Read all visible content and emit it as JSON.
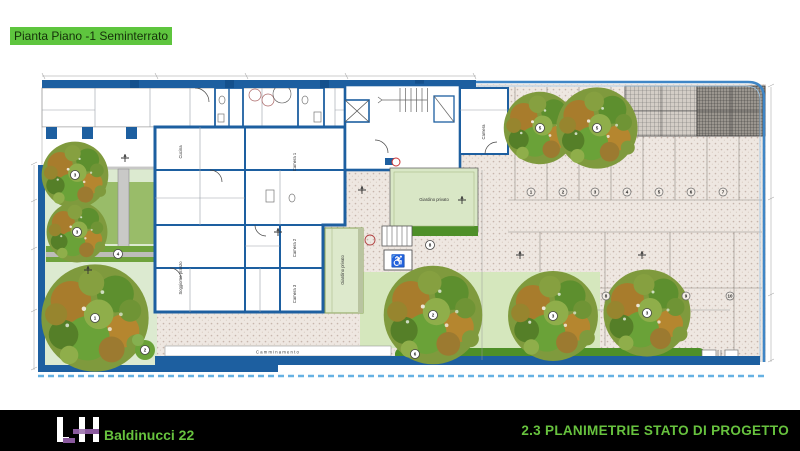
{
  "title": {
    "text": "Pianta Piano -1 Seminterrato",
    "highlight_color": "#5ec53e"
  },
  "footer": {
    "logo_text": "LH",
    "project": "Baldinucci 22",
    "sheet": "2.3 PLANIMETRIE STATO DI PROGETTO",
    "bg": "#000000",
    "accent_green": "#67c23e",
    "logo_purple": "#8a5a9e"
  },
  "plan": {
    "colors": {
      "wall_blue": "#1d5fa0",
      "fence_blue": "#3f86c6",
      "lawn_green": "#dcead0",
      "hedge_green": "#4e8f28",
      "paving": "#eee7e1"
    },
    "labels": {
      "camera": "Camera",
      "camera1": "Camera 1",
      "camera2": "Camera 2",
      "camera3": "Camera 3",
      "cucina": "Cucina",
      "soggiorno": "Soggiorno pranzo",
      "giardino_strip": "Giardino privato",
      "giardino_rect": "Giardino privato",
      "camminamento": "Camminamento"
    },
    "symbols": {
      "wheelchair": "♿"
    },
    "markers": {
      "left_top": "3",
      "left_mid": "3",
      "left_big": "1",
      "left_small": "2",
      "hedge": "4",
      "right_top_1": "5",
      "right_top_2": "5",
      "bottom_1": "2",
      "bottom_2": "3",
      "bottom_3": "3",
      "bottom_strip": "6",
      "garden_mid": "8",
      "parking_row1": [
        "1",
        "2",
        "3",
        "4",
        "5",
        "6",
        "7"
      ],
      "parking_row2": [
        "8",
        "9",
        "10"
      ]
    }
  }
}
